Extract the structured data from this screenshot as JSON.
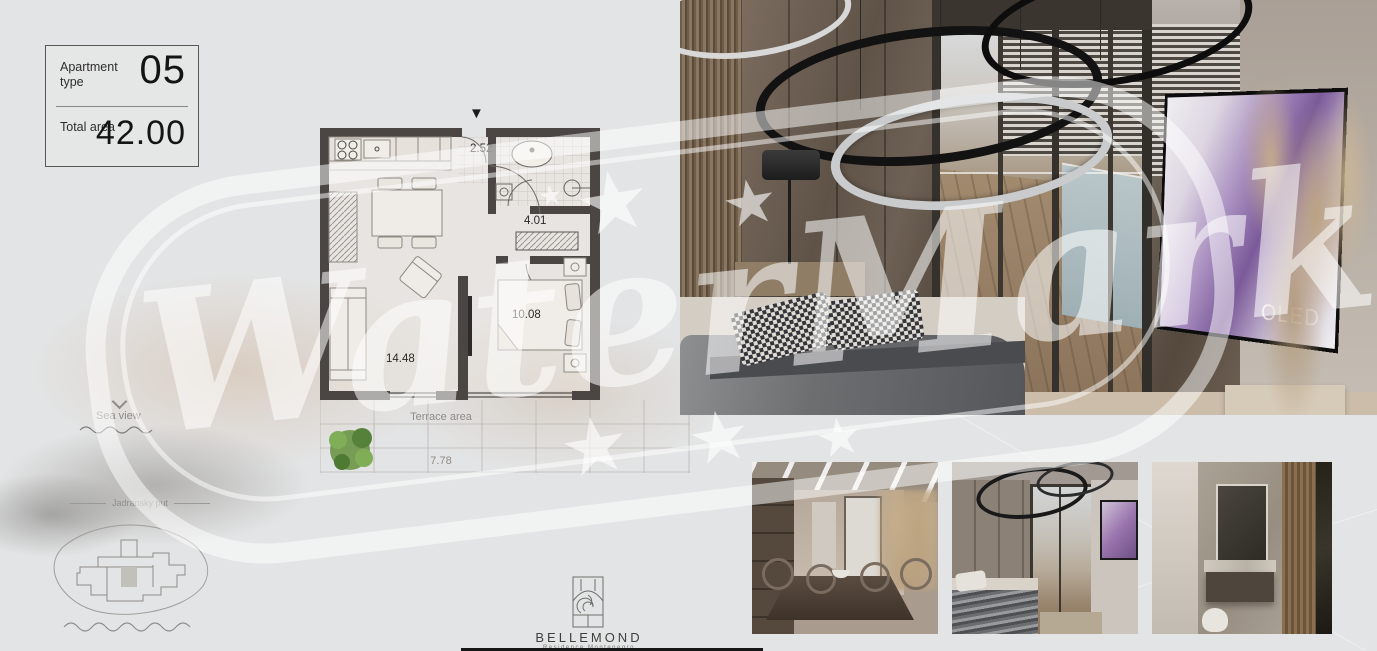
{
  "info_card": {
    "apartment_type_label": "Apartment type",
    "apartment_type_value": "05",
    "total_area_label": "Total area",
    "total_area_value": "42.00"
  },
  "floorplan": {
    "entry_area": "2.52",
    "hall_area": "4.01",
    "bedroom_area": "10.08",
    "living_area": "14.48",
    "terrace_label": "Terrace area",
    "terrace_area": "7.78",
    "entry_arrow": "▼"
  },
  "annotations": {
    "sea_view_label": "Sea view",
    "road_label": "Jadransky put"
  },
  "logo": {
    "name": "BELLEMOND",
    "tagline": "Residence Montenegro"
  },
  "main_render": {
    "tv_text": "OLED"
  },
  "watermark": {
    "text": "WaterMark",
    "star": "★"
  },
  "colors": {
    "wall": "#4b4644",
    "tree_green": "#6a9446",
    "watermark_white": "rgba(255,255,255,0.55)",
    "tv_purple": "#8a5f9e",
    "logo_ink": "#3f3f3d"
  }
}
